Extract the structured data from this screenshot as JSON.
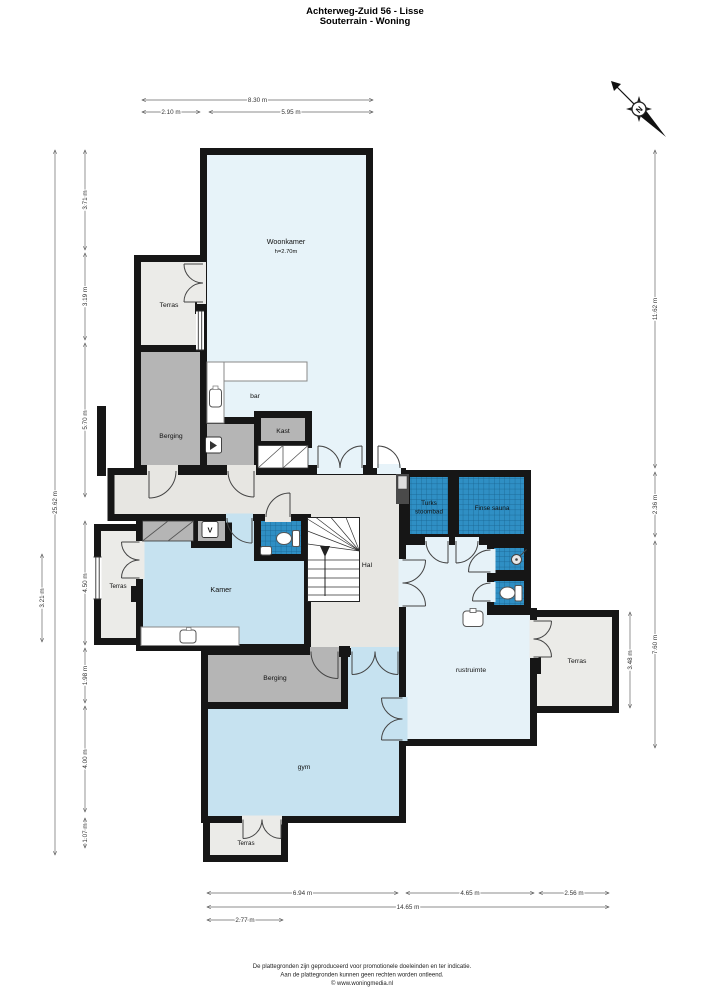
{
  "title": {
    "line1": "Achterweg-Zuid 56 - Lisse",
    "line2": "Souterrain - Woning"
  },
  "compass": {
    "north_label": "N"
  },
  "floorplan": {
    "room_labels": [
      {
        "id": "woonkamer",
        "label": "Woonkamer",
        "sub": "h=2.70m",
        "x": 286,
        "y": 244,
        "size": 7.2
      },
      {
        "id": "terras-linksboven",
        "label": "Terras",
        "x": 169,
        "y": 307,
        "size": 6.8
      },
      {
        "id": "berging-boven",
        "label": "Berging",
        "x": 171,
        "y": 438,
        "size": 6.8
      },
      {
        "id": "bar",
        "label": "bar",
        "x": 255,
        "y": 398,
        "size": 6.8
      },
      {
        "id": "kast",
        "label": "Kast",
        "x": 283,
        "y": 433,
        "size": 6.8
      },
      {
        "id": "hal",
        "label": "Hal",
        "x": 367,
        "y": 567,
        "size": 6.8
      },
      {
        "id": "kamer",
        "label": "Kamer",
        "x": 221,
        "y": 592,
        "size": 7.2
      },
      {
        "id": "terras-links",
        "label": "Terras",
        "x": 118,
        "y": 588,
        "size": 6.2
      },
      {
        "id": "turks-stoombad",
        "label": "Turks",
        "label2": "stoombad",
        "x": 429,
        "y": 505,
        "size": 6.4
      },
      {
        "id": "finse-sauna",
        "label": "Finse sauna",
        "x": 492,
        "y": 510,
        "size": 6.4
      },
      {
        "id": "rustruimte",
        "label": "rustruimte",
        "x": 471,
        "y": 672,
        "size": 6.8
      },
      {
        "id": "terras-rechts",
        "label": "Terras",
        "x": 577,
        "y": 663,
        "size": 6.8
      },
      {
        "id": "berging-onder",
        "label": "Berging",
        "x": 275,
        "y": 680,
        "size": 6.8
      },
      {
        "id": "gym",
        "label": "gym",
        "x": 304,
        "y": 769,
        "size": 6.8
      },
      {
        "id": "terras-onder",
        "label": "Terras",
        "x": 246,
        "y": 845,
        "size": 6.2
      },
      {
        "id": "meterkast",
        "label": "V",
        "x": 210,
        "y": 532.5,
        "size": 7.5,
        "bold": true
      }
    ],
    "dimensions": {
      "top": [
        {
          "label": "8.30 m",
          "x1": 142,
          "y1": 100,
          "x2": 373,
          "y2": 100
        },
        {
          "label": "2.10 m",
          "x1": 142,
          "y1": 112,
          "x2": 200,
          "y2": 112
        },
        {
          "label": "5.95 m",
          "x1": 209,
          "y1": 112,
          "x2": 373,
          "y2": 112
        }
      ],
      "bottom": [
        {
          "label": "6.94 m",
          "x1": 207,
          "y1": 893,
          "x2": 398,
          "y2": 893
        },
        {
          "label": "4.65 m",
          "x1": 406,
          "y1": 893,
          "x2": 534,
          "y2": 893
        },
        {
          "label": "2.56 m",
          "x1": 539,
          "y1": 893,
          "x2": 609,
          "y2": 893
        },
        {
          "label": "14.65 m",
          "x1": 207,
          "y1": 907,
          "x2": 609,
          "y2": 907
        },
        {
          "label": "2.77 m",
          "x1": 207,
          "y1": 920,
          "x2": 283,
          "y2": 920
        }
      ],
      "left": [
        {
          "label": "25.62 m",
          "x1": 55,
          "y1": 150,
          "x2": 55,
          "y2": 855
        },
        {
          "label": "3.71 m",
          "x1": 85,
          "y1": 150,
          "x2": 85,
          "y2": 250
        },
        {
          "label": "3.19 m",
          "x1": 85,
          "y1": 253,
          "x2": 85,
          "y2": 340
        },
        {
          "label": "5.70 m",
          "x1": 85,
          "y1": 343,
          "x2": 85,
          "y2": 497
        },
        {
          "label": "4.50 m",
          "x1": 85,
          "y1": 521,
          "x2": 85,
          "y2": 645
        },
        {
          "label": "1.98 m",
          "x1": 85,
          "y1": 648,
          "x2": 85,
          "y2": 703
        },
        {
          "label": "4.00 m",
          "x1": 85,
          "y1": 706,
          "x2": 85,
          "y2": 812
        },
        {
          "label": "1.07 m",
          "x1": 85,
          "y1": 818,
          "x2": 85,
          "y2": 848
        },
        {
          "label": "3.21 m",
          "x1": 42,
          "y1": 554,
          "x2": 42,
          "y2": 642
        }
      ],
      "right": [
        {
          "label": "11.62 m",
          "x1": 655,
          "y1": 150,
          "x2": 655,
          "y2": 468
        },
        {
          "label": "2.36 m",
          "x1": 655,
          "y1": 472,
          "x2": 655,
          "y2": 537
        },
        {
          "label": "7.60 m",
          "x1": 655,
          "y1": 541,
          "x2": 655,
          "y2": 748
        },
        {
          "label": "3.48 m",
          "x1": 630,
          "y1": 612,
          "x2": 630,
          "y2": 708
        }
      ]
    },
    "colors": {
      "wall": "#161616",
      "living_blue": "#e7f3f9",
      "room_blue": "#c6e2f0",
      "pale_blue": "#e6f2f8",
      "tile_blue": "#2f8fc4",
      "tile_grid": "#18618c",
      "terrace_gray": "#ebebe8",
      "storage_gray": "#b5b5b5",
      "hall_gray": "#e7e6e2"
    }
  },
  "footer": {
    "line1": "De plattegronden zijn geproduceerd voor promotionele doeleinden en ter indicatie.",
    "line2": "Aan de plattegronden kunnen geen rechten worden ontleend.",
    "line3": "© www.woningmedia.nl"
  }
}
